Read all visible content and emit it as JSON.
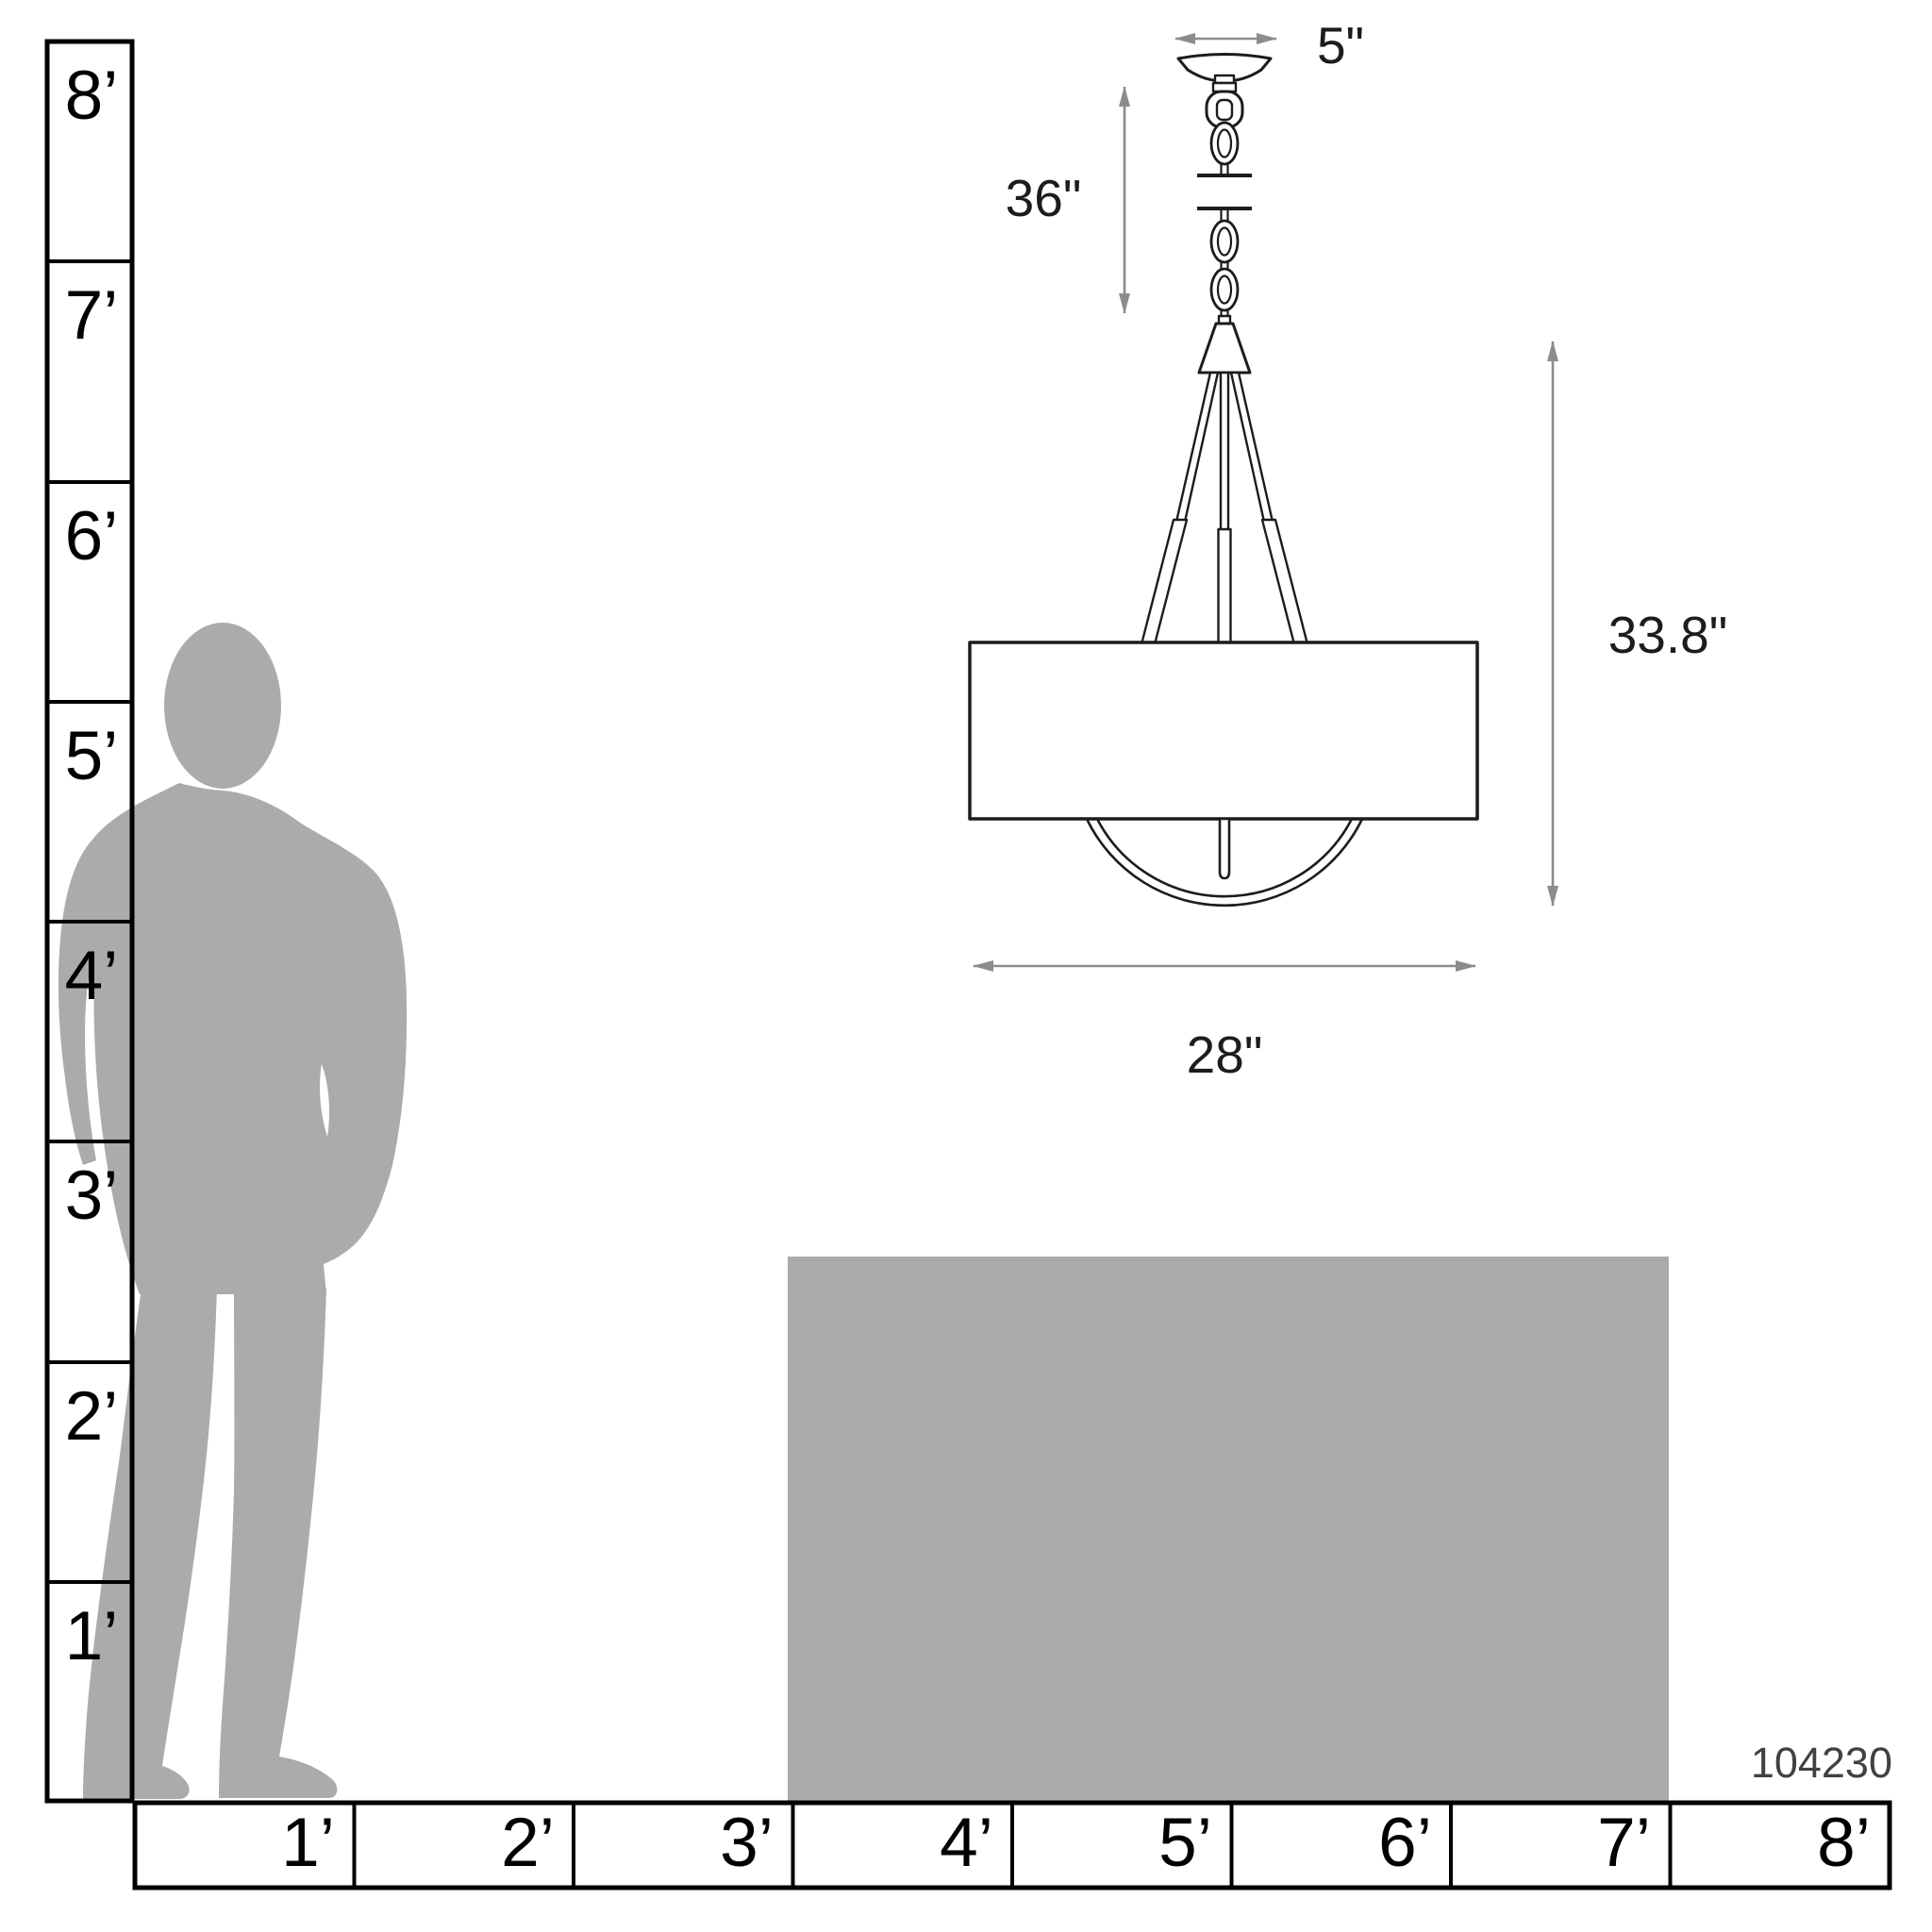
{
  "diagram": {
    "product_number": "104230",
    "dimension_labels": {
      "canopy_width": "5\"",
      "hang_length": "36\"",
      "fixture_height": "33.8\"",
      "shade_width": "28\""
    },
    "vertical_ruler": {
      "labels": [
        "8’",
        "7’",
        "6’",
        "5’",
        "4’",
        "3’",
        "2’",
        "1’"
      ]
    },
    "horizontal_ruler": {
      "labels": [
        "1’",
        "2’",
        "3’",
        "4’",
        "5’",
        "6’",
        "7’",
        "8’"
      ]
    },
    "colors": {
      "silhouette_gray": "#ababab",
      "table_gray": "#ababab",
      "dimension_line_gray": "#8c8c8c",
      "outline_black": "#1c1c1c",
      "product_number_gray": "#414141"
    }
  }
}
